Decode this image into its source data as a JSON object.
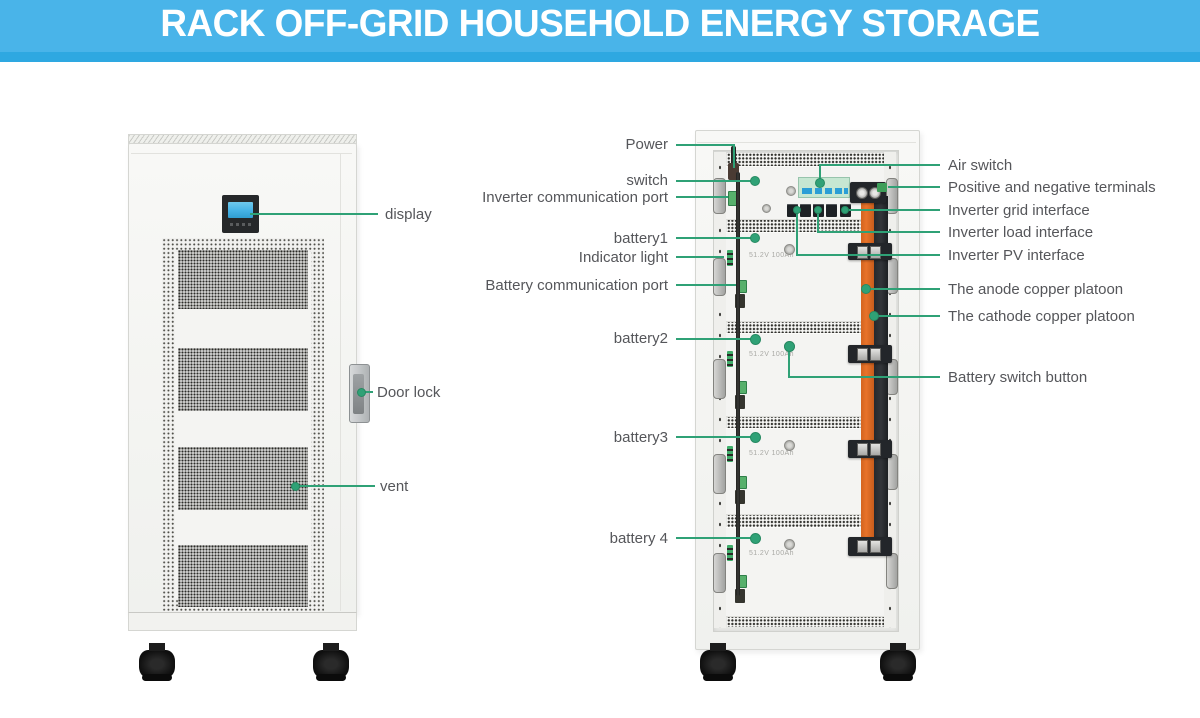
{
  "banner": {
    "title": "RACK OFF-GRID HOUSEHOLD ENERGY STORAGE"
  },
  "front_view": {
    "labels": [
      {
        "id": "display",
        "text": "display"
      },
      {
        "id": "door_lock",
        "text": "Door lock"
      },
      {
        "id": "vent",
        "text": "vent"
      }
    ]
  },
  "rear_view": {
    "left_labels": [
      {
        "id": "power",
        "text": "Power"
      },
      {
        "id": "switch",
        "text": "switch"
      },
      {
        "id": "inverter_comm_port",
        "text": "Inverter communication port"
      },
      {
        "id": "battery1",
        "text": "battery1"
      },
      {
        "id": "indicator_light",
        "text": "Indicator light"
      },
      {
        "id": "battery_comm_port",
        "text": "Battery communication port"
      },
      {
        "id": "battery2",
        "text": "battery2"
      },
      {
        "id": "battery3",
        "text": "battery3"
      },
      {
        "id": "battery4",
        "text": "battery 4"
      }
    ],
    "right_labels": [
      {
        "id": "air_switch",
        "text": "Air switch"
      },
      {
        "id": "pos_neg_terminals",
        "text": "Positive and negative terminals"
      },
      {
        "id": "inverter_grid",
        "text": "Inverter grid interface"
      },
      {
        "id": "inverter_load",
        "text": "Inverter load interface"
      },
      {
        "id": "inverter_pv",
        "text": "Inverter PV interface"
      },
      {
        "id": "anode_copper_platoon",
        "text": "The anode copper platoon"
      },
      {
        "id": "cathode_copper_platoon",
        "text": "The cathode copper platoon"
      },
      {
        "id": "battery_switch_button",
        "text": "Battery switch button"
      }
    ],
    "module_rating": "51.2V 100Ah"
  },
  "colors": {
    "banner_blue": "#49b4e9",
    "banner_strip_blue": "#2ea8e1",
    "accent_green": "#2fa176",
    "label_text_gray": "#55565a",
    "busbar_orange": "#e8732a",
    "busbar_black": "#33363a",
    "lcd_blue": "#45b2e6"
  }
}
